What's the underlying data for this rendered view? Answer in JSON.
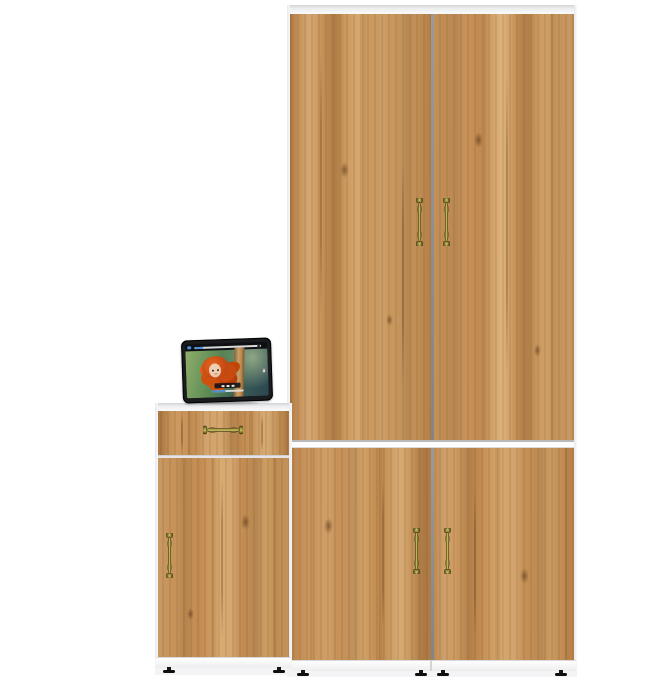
{
  "palette": {
    "background": "#ffffff",
    "wood_base": "#c68f57",
    "wood_light": "#dcb284",
    "wood_dark": "#a06b38",
    "carcass_white": "#f4f4f6",
    "carcass_line": "#c9c9cc",
    "door_gap": "#8f8f8f",
    "handle_brass_dark": "#4f4a18",
    "handle_brass_mid": "#a99c45",
    "handle_brass_light": "#cfc269",
    "foot_black": "#161616",
    "tablet_bezel": "#191b1d",
    "player_accent": "#4a8fd6",
    "video_green": "#8fae6a",
    "video_teal": "#2b4552",
    "pole_tan": "#c9a06a",
    "hair_orange": "#d84e16",
    "skin": "#ecc9ab"
  },
  "furniture": {
    "wardrobe": {
      "finish": "light-oak-woodgrain",
      "carcass_color": "white",
      "upper_section": {
        "doors": 2,
        "handle_style": "vertical-brass",
        "handles": 2
      },
      "lower_section": {
        "doors": 2,
        "handle_style": "vertical-brass",
        "handles": 2
      },
      "feet_count": 4
    },
    "side_cabinet": {
      "finish": "light-oak-woodgrain",
      "carcass_color": "white",
      "drawer": {
        "handle_style": "horizontal-brass",
        "handles": 1
      },
      "door": {
        "handle_style": "vertical-brass",
        "handles": 1
      },
      "feet_count": 2
    }
  },
  "tablet": {
    "orientation": "landscape",
    "bezel_color": "black",
    "player": {
      "top_progress_fraction": 0.14,
      "bottom_progress_fraction": 0.45,
      "icons": [
        "scrubber-track-icon",
        "control-bar-icon",
        "fullscreen-icon"
      ]
    }
  }
}
